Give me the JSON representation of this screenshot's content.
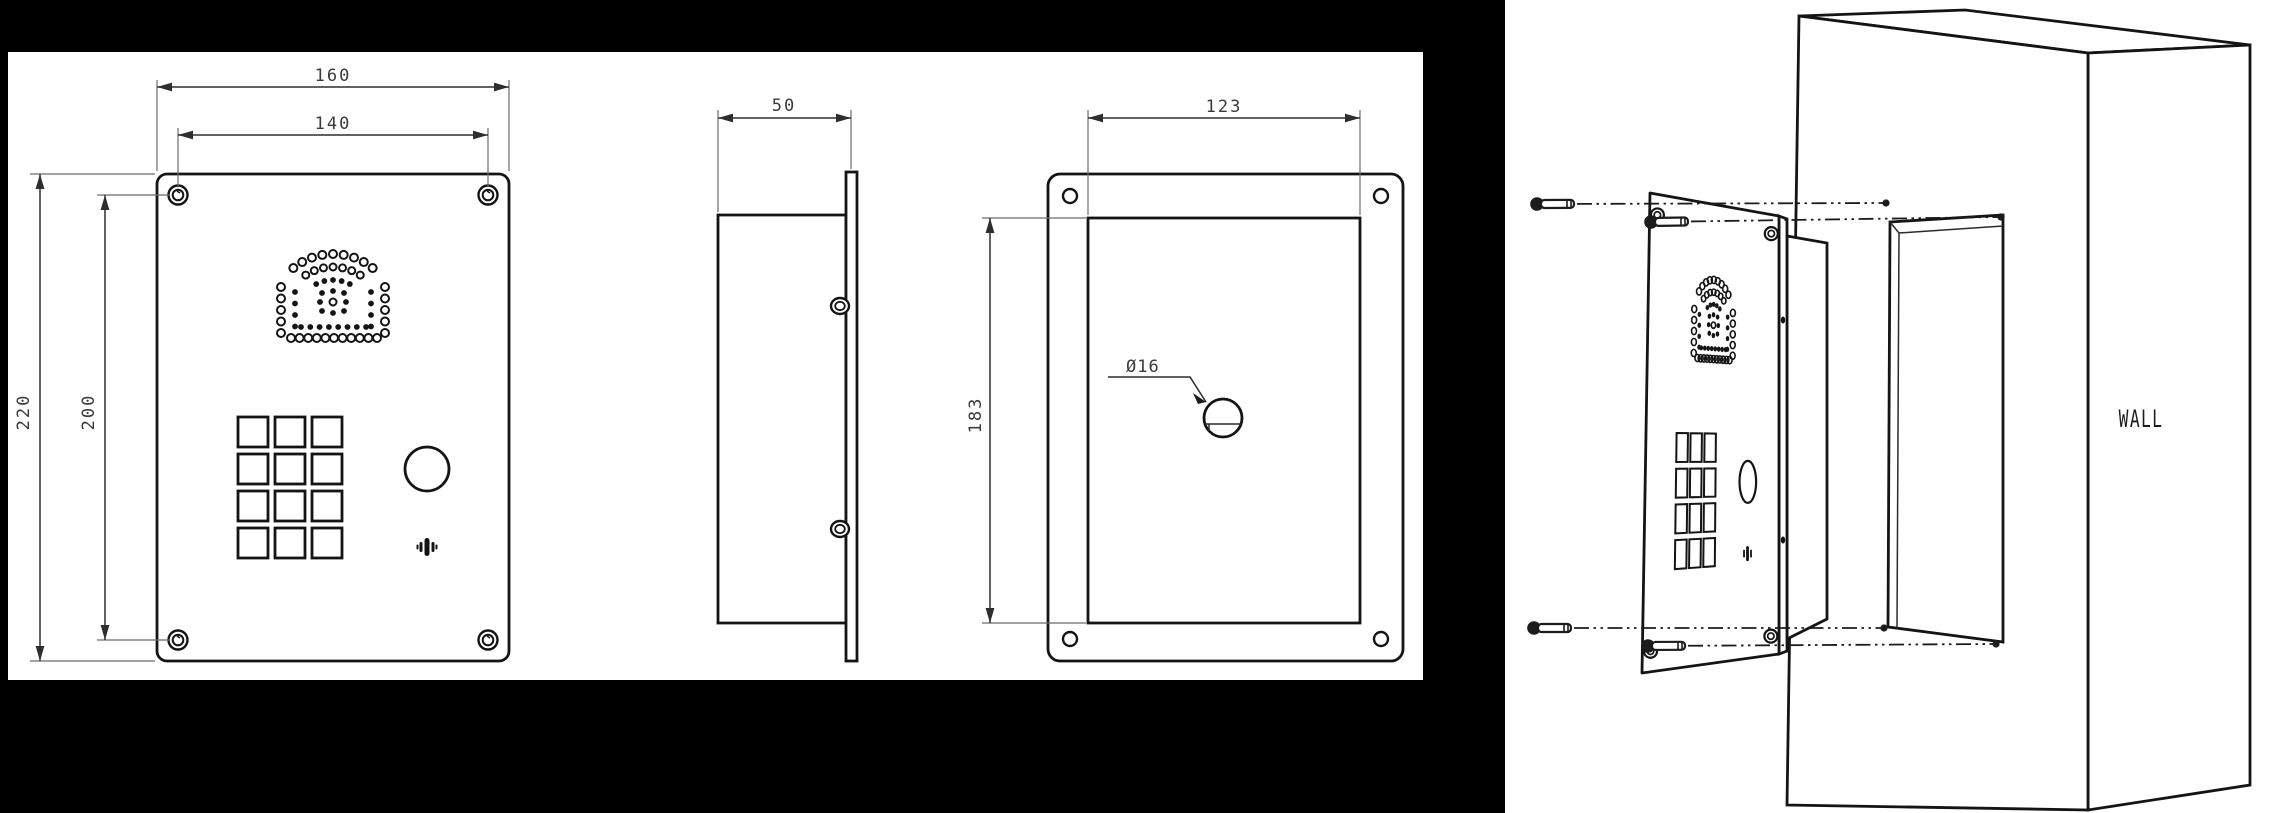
{
  "drawing": {
    "colors": {
      "background": "#000000",
      "paper": "#ffffff",
      "line": "#141414",
      "dim_line": "#2e2e2e",
      "dim_text": "#3a3a3a"
    },
    "front": {
      "width_label": "160",
      "hole_width_label": "140",
      "height_label": "220",
      "hole_height_label": "200"
    },
    "side": {
      "depth_label": "50"
    },
    "rear": {
      "cutout_width_label": "123",
      "cutout_height_label": "183",
      "hole_dia_label": "Ø16"
    },
    "installation": {
      "wall_label": "WALL"
    }
  }
}
